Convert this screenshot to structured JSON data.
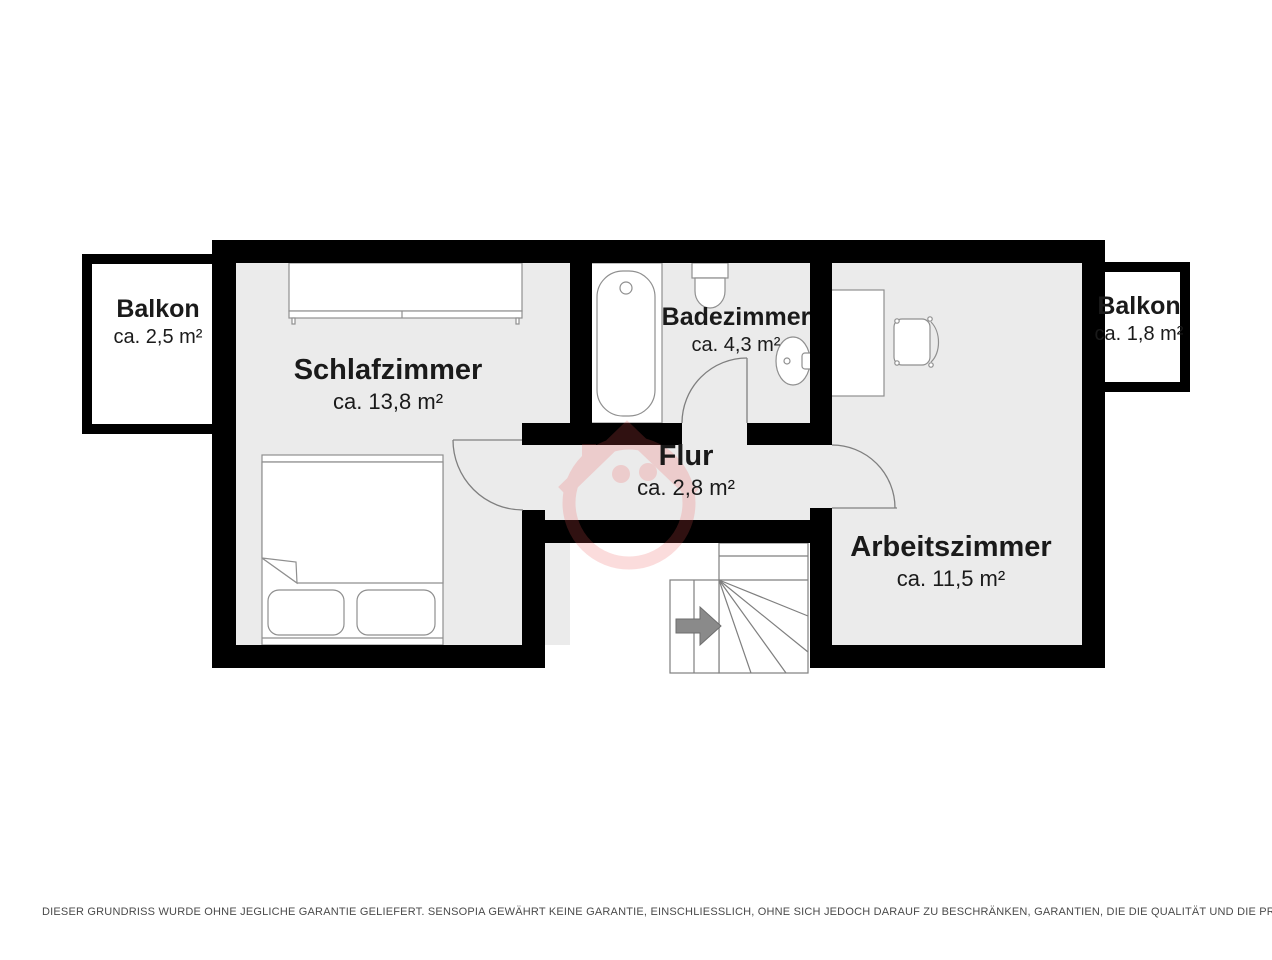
{
  "document_type": "floor-plan",
  "rooms": [
    {
      "name": "Balkon",
      "area": "ca. 2,5 m²"
    },
    {
      "name": "Schlafzimmer",
      "area": "ca. 13,8 m²"
    },
    {
      "name": "Badezimmer",
      "area": "ca. 4,3 m²"
    },
    {
      "name": "Flur",
      "area": "ca. 2,8 m²"
    },
    {
      "name": "Arbeitszimmer",
      "area": "ca. 11,5 m²"
    },
    {
      "name": "Balkon",
      "area": "ca. 1,8 m²"
    }
  ],
  "footer": {
    "disclaimer": "DIESER GRUNDRISS WURDE OHNE JEGLICHE GARANTIE GELIEFERT. SENSOPIA GEWÄHRT KEINE GARANTIE, EINSCHLIESSLICH, OHNE SICH JEDOCH DARAUF ZU BESCHRÄNKEN, GARANTIEN, DIE DIE QUALITÄT UND DIE PRÄZISION DER ABMESSUNGEN BETREFFEN."
  },
  "colors": {
    "wall": "#000000",
    "floor": "#ebebeb",
    "thin_outline": "#7f7f7f",
    "stair_arrow": "#8a8a8a",
    "watermark": "#f05555",
    "label_text": "#1a1a1a",
    "footer_text": "#4a4a4a"
  }
}
